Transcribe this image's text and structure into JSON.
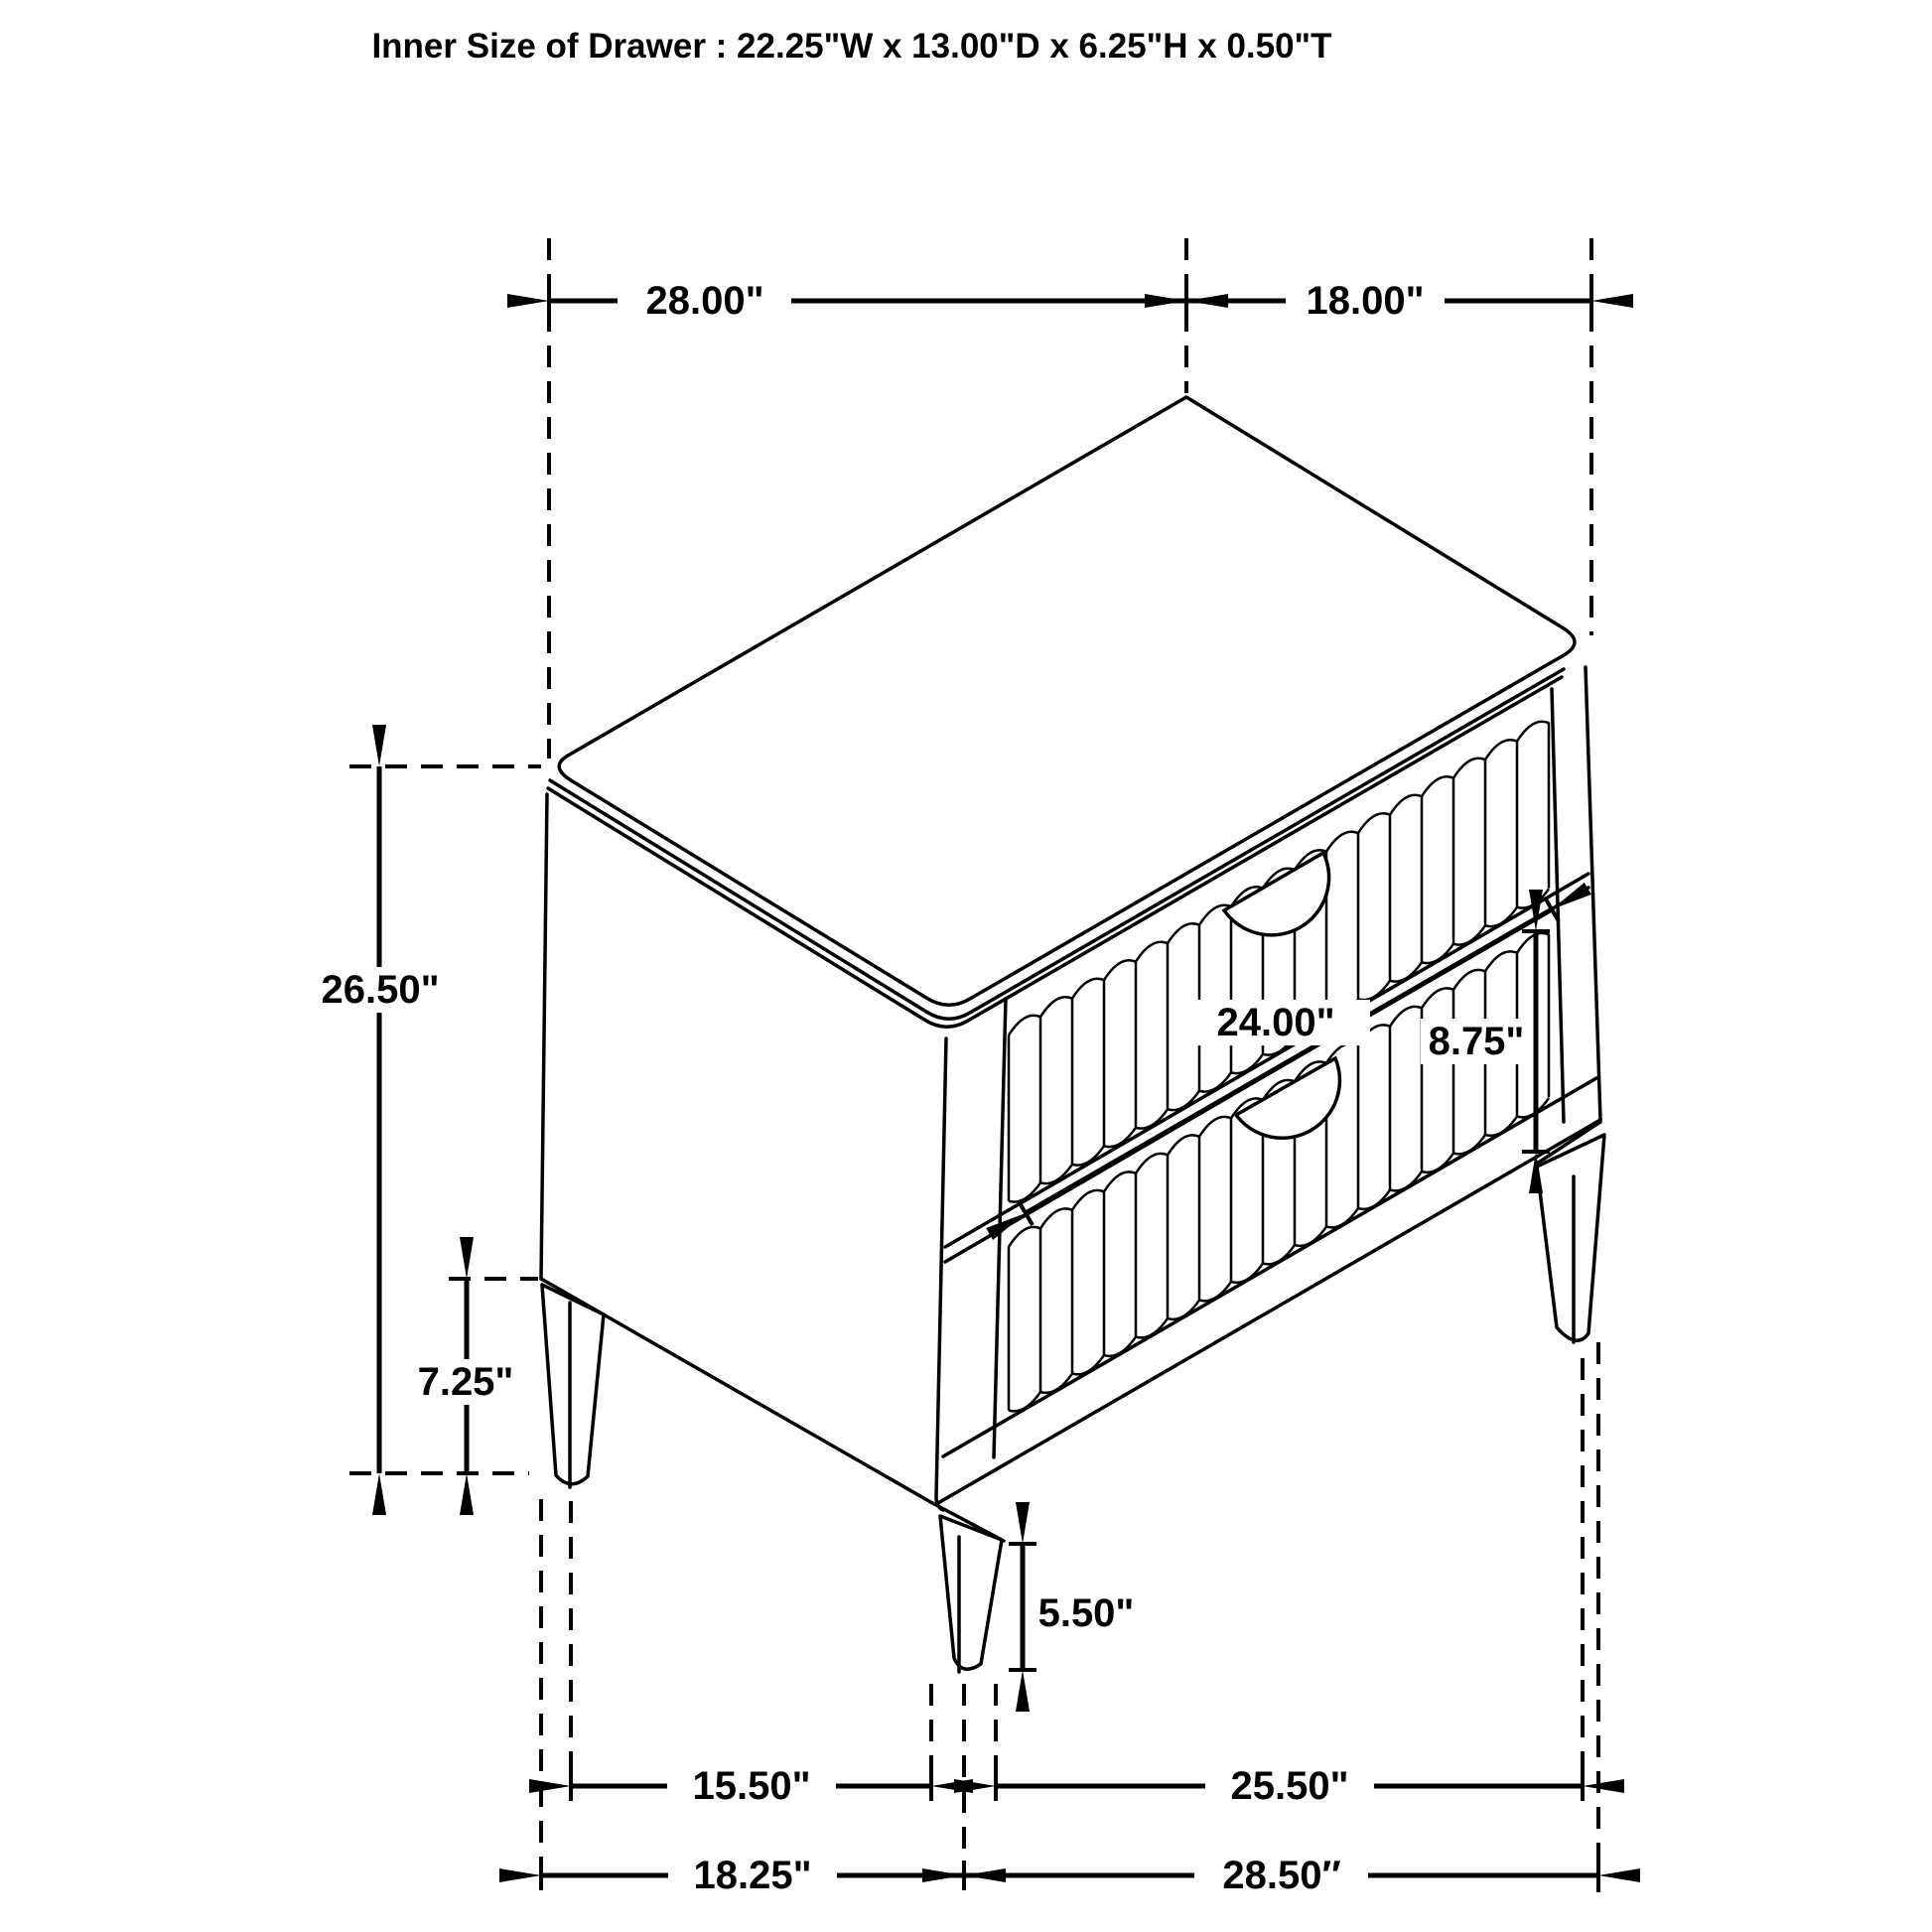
{
  "title": "Inner Size of Drawer : 22.25\"W x 13.00\"D x 6.25\"H x 0.50\"T",
  "dimensions": {
    "top_width": "28.00\"",
    "top_depth": "18.00\"",
    "overall_height": "26.50\"",
    "back_leg_height": "7.25\"",
    "drawer_front_width": "24.00\"",
    "drawer_front_height": "8.75\"",
    "front_leg_height": "5.50\"",
    "leg_span_side_inner": "15.50\"",
    "leg_span_front_inner": "25.50\"",
    "base_depth_overall": "18.25\"",
    "base_width_overall": "28.50″"
  },
  "colors": {
    "line": "#000000",
    "background": "#ffffff"
  }
}
